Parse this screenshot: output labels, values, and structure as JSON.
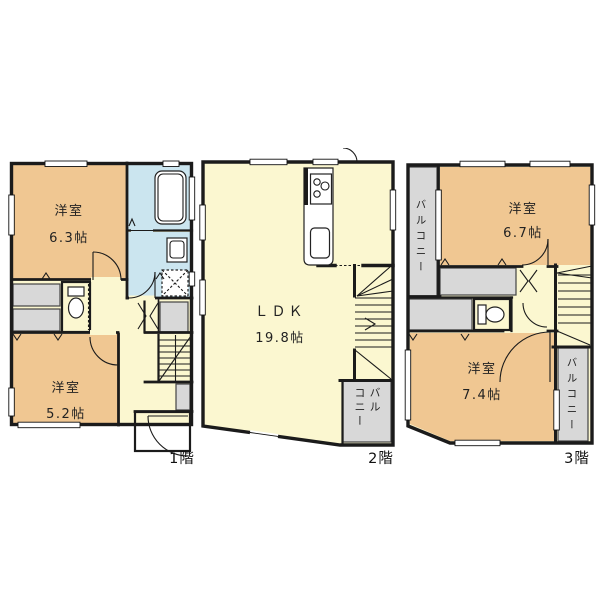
{
  "colors": {
    "background": "#ffffff",
    "wall": "#1b1b1b",
    "room": "#f0c792",
    "living": "#fbf7d0",
    "wet": "#cbe5ef",
    "balcony": "#d8d8d8",
    "text": "#222222"
  },
  "floors": [
    {
      "label": "1階",
      "rooms": [
        {
          "name": "洋室",
          "size": "6.3帖"
        },
        {
          "name": "洋室",
          "size": "5.2帖"
        }
      ]
    },
    {
      "label": "2階",
      "rooms": [
        {
          "name": "ＬＤＫ",
          "size": "19.8帖"
        }
      ],
      "balcony": {
        "line1": "バル",
        "line2": "コニー"
      }
    },
    {
      "label": "3階",
      "rooms": [
        {
          "name": "洋室",
          "size": "6.7帖"
        },
        {
          "name": "洋室",
          "size": "7.4帖"
        }
      ],
      "balcony_left": "バルコニー",
      "balcony_right": "バルコニー"
    }
  ]
}
